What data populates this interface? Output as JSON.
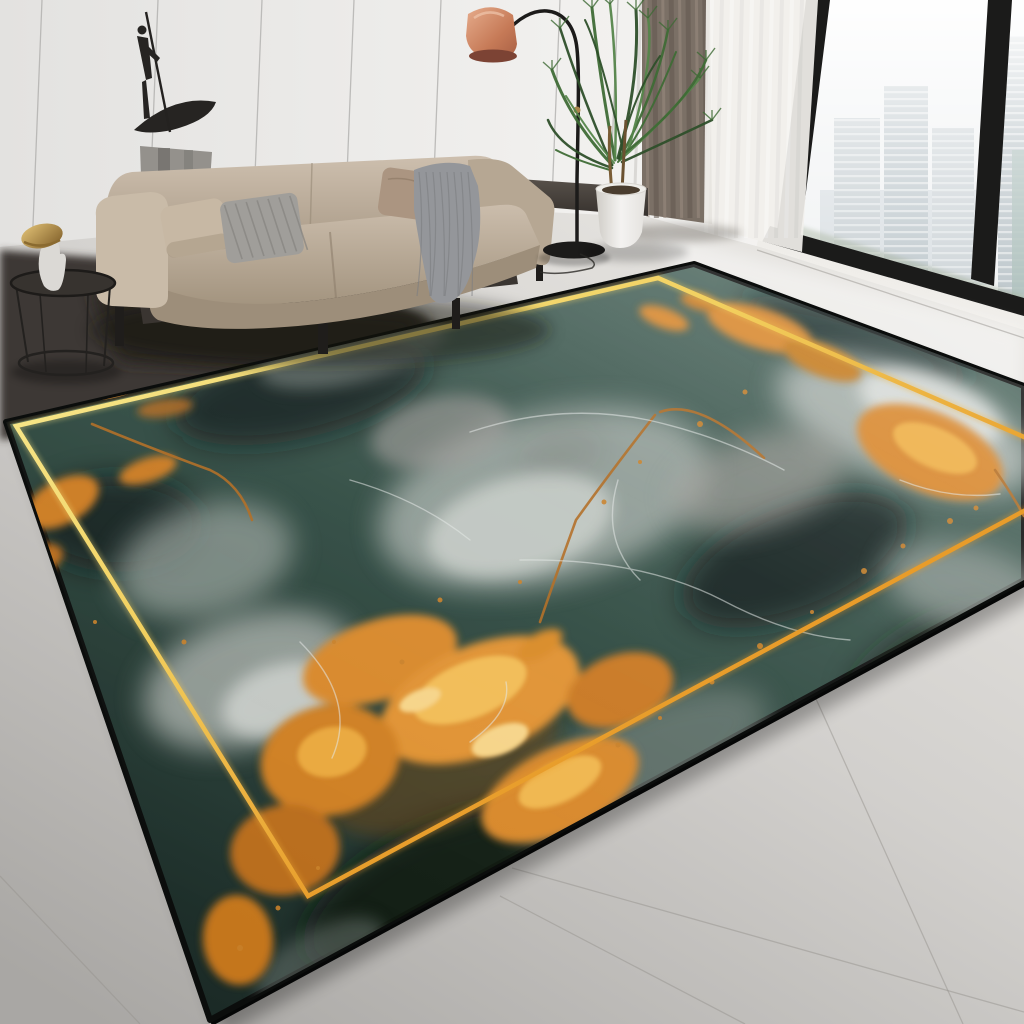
{
  "meta": {
    "kind": "product-photo",
    "subject": "teal-and-gold marble pattern area rug in a modern living room",
    "canvas": {
      "width": 1024,
      "height": 1024
    }
  },
  "palette": {
    "wall": "#efeeec",
    "wallShade": "#dddcda",
    "wallSeam": "#a9a8a6",
    "ledge": "#4e4741",
    "curtain": "#7b7066",
    "curtainDark": "#625850",
    "curtainLight": "#9a8d81",
    "sheer": "#f2f0ec",
    "windowFrame": "#1b1b1a",
    "sky": "#f0f2f3",
    "towerA": "#c6ced2",
    "towerB": "#bdc7cc",
    "towerC": "#ccd3d7",
    "towerTeal": "#a9bdb8",
    "cityGreen": "#9aa78f",
    "floorLight": "#e8e6e2",
    "floorMid": "#cfcdca",
    "floorDark": "#acaaa7",
    "grout": "#97948f",
    "platform": "#3e3834",
    "platformCore": "#2b2724",
    "rugBaseLight": "#4a655c",
    "rugBaseMid": "#2e4940",
    "rugBaseDark": "#1b2a26",
    "rugSmoke": "#a7b0ab",
    "rugSmokeBright": "#ccd1cc",
    "rugDarkPatch": "#0e1a17",
    "gold": "#d8862b",
    "goldBright": "#f2bc55",
    "goldPale": "#f6d488",
    "goldDeep": "#b06a1a",
    "goldBronze": "#6e4612",
    "borderGoldLight": "#f8ef9a",
    "borderGoldMid": "#f2cf5e",
    "borderGoldDeep": "#d9761a",
    "rugEdge": "#0b0d0c",
    "rugVein": "#e3e8e5",
    "copperVein": "#b06a20",
    "sofaTop": "#c9bbaa",
    "sofaMid": "#b6a793",
    "sofaFront": "#9d8e7a",
    "pillowBeige": "#c7b8a4",
    "pillowGrey": "#a09e9a",
    "pillowGreyStripe": "#85837f",
    "pillowTaupe": "#ab9581",
    "blanket": "#94969a",
    "blanketRib": "#7b7d81",
    "legDark": "#1f1d1b",
    "lampMetal": "#1c1b1a",
    "lampShade": "#d19070",
    "lampShadeDark": "#a85f44",
    "lampJoint": "#a8854c",
    "plantDark": "#2e4f2a",
    "plantMid": "#3f6b36",
    "plantLight": "#55854a",
    "stem": "#7a5c35",
    "pot": "#f4f3f1",
    "potShade": "#cfccc6",
    "soil": "#4a3d2f",
    "pedestal": "#94918c",
    "pedestalStreak": "#6e6b66",
    "sculpture": "#262422",
    "wire": "#23211f",
    "tableTop": "#37332f",
    "figurineBody": "#dbd9d5",
    "figurineGold": "#c79d4e"
  },
  "scene": {
    "objects": [
      "paneled-wall",
      "abstract-sculpture",
      "stone-pedestal",
      "beige-sofa",
      "striped-pillow",
      "throw-blanket",
      "wire-side-table",
      "mushroom-figurine",
      "arc-floor-lamp",
      "potted-palm",
      "taupe-curtain",
      "sheer-curtain",
      "floor-to-ceiling-window",
      "city-skyline",
      "marble-tile-floor",
      "teal-gold-marble-rug",
      "gold-border-line"
    ]
  }
}
